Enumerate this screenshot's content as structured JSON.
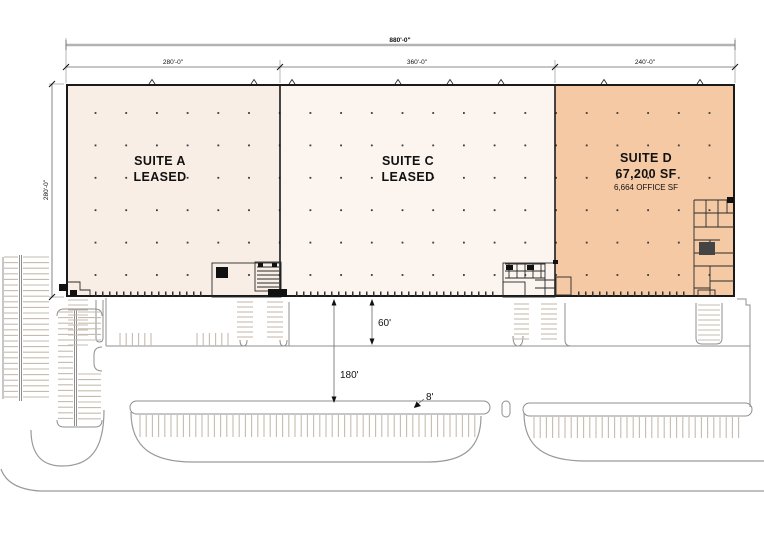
{
  "plan": {
    "suites": [
      {
        "name": "SUITE A",
        "status": "LEASED",
        "width_dim": "280'-0\"",
        "fill": "#f9eee5"
      },
      {
        "name": "SUITE C",
        "status": "LEASED",
        "width_dim": "360'-0\"",
        "fill": "#fcf5ef"
      },
      {
        "name": "SUITE D",
        "area": "67,200 SF",
        "office_area": "6,664 OFFICE SF",
        "width_dim": "240'-0\"",
        "fill": "#f4c9a4"
      }
    ],
    "dims": {
      "overall_width": "880'-0\"",
      "building_depth": "280'-0\"",
      "dock_apron_depth": "60'",
      "truck_court_depth": "180'",
      "median_width": "8'"
    },
    "colors": {
      "wall": "#1a1a1a",
      "site_line": "#8f8f8f",
      "stall_line": "#c6bbae"
    }
  }
}
